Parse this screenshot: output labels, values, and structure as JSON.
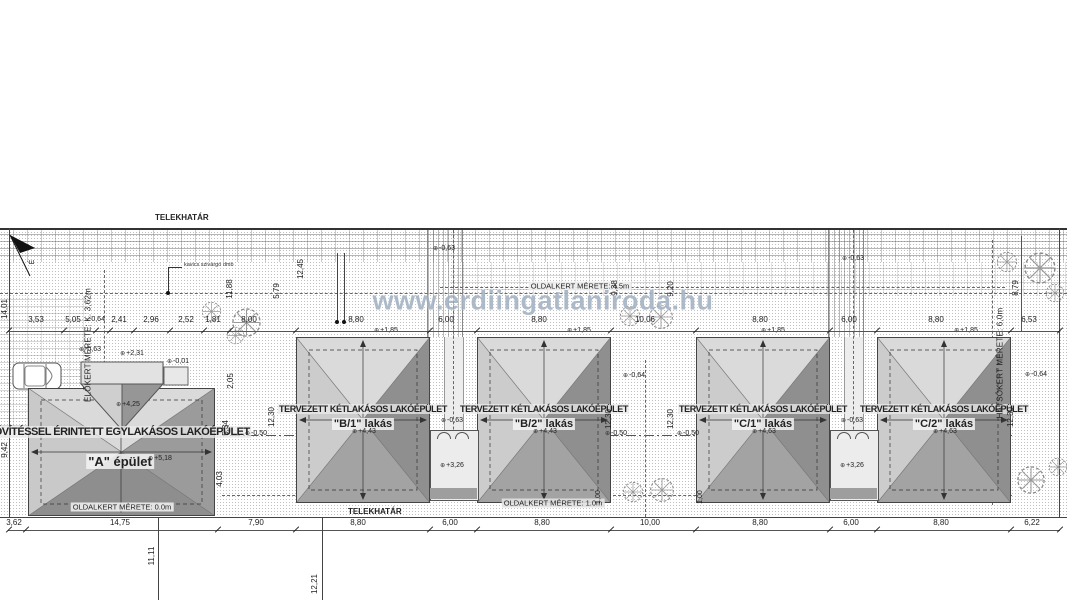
{
  "watermark": "www.erdiingatlaniroda.hu",
  "labels": {
    "telekhatar_top": "TELEKHATÁR",
    "telekhatar_bottom": "TELEKHATÁR",
    "elokert": "ELŐKERT MÉRETE: K. 3,62m",
    "hatsokert": "HÁTSÓKERT MÉRETE: 6,0m",
    "oldalkert_top": "OLDALKERT MÉRETE: 4.5m",
    "oldalkert_a": "OLDALKERT MÉRETE: 0.0m",
    "oldalkert_b": "OLDALKERT MÉRETE: 1.0m",
    "drain_note": "kavics szivárgó dmb",
    "north": "É"
  },
  "buildings": {
    "a": {
      "title": "BŐVÍTÉSSEL ÉRINTETT EGYLAKÁSOS LAKÓÉPÜLET",
      "name": "\"A\" épület",
      "ridge": "+5,18",
      "ext_corner": "-0,63",
      "ext_eave": "+2,31",
      "ext_ground": "-0,01",
      "ext_ridge": "+4,25"
    },
    "b1": {
      "title": "TERVEZETT KÉTLAKÁSOS LAKÓÉPÜLET",
      "name": "\"B/1\" lakás",
      "ridge": "+4,43",
      "eave": "+1,85"
    },
    "b2": {
      "title": "TERVEZETT KÉTLAKÁSOS LAKÓÉPÜLET",
      "name": "\"B/2\" lakás",
      "ridge": "+4,43",
      "eave": "+1,85"
    },
    "c1": {
      "title": "TERVEZETT KÉTLAKÁSOS LAKÓÉPÜLET",
      "name": "\"C/1\" lakás",
      "ridge": "+4,63",
      "eave": "+1,85"
    },
    "c2": {
      "title": "TERVEZETT KÉTLAKÁSOS LAKÓÉPÜLET",
      "name": "\"C/2\" lakás",
      "ridge": "+4,63",
      "eave": "+1,85"
    }
  },
  "connectors": {
    "b": {
      "ground": "-0,63",
      "terrace": "+3,26"
    },
    "c": {
      "ground": "-0,63",
      "terrace": "+3,26"
    }
  },
  "elev": {
    "gap_b": "-0,63",
    "gap_c": "-0,63",
    "mid": "-0,64",
    "right": "-0,64",
    "half1": "-0,50",
    "half2": "-0,50",
    "half3": "-0,50"
  },
  "dims_top": [
    "3,53",
    "5,05",
    "-0,64",
    "2,41",
    "2,96",
    "2,52",
    "1,81",
    "8,00",
    "8,80",
    "6,00",
    "8,80",
    "10,06",
    "8,80",
    "6,00",
    "8,80",
    "6,53"
  ],
  "dims_bottom": [
    "3,62",
    "14,75",
    "7,90",
    "8,80",
    "6,00",
    "8,80",
    "10,00",
    "8,80",
    "6,00",
    "8,80",
    "6,22"
  ],
  "dims_vert": {
    "left1": "14,01",
    "left2": "9,42",
    "ab1": "11,88",
    "ab2": "5,79",
    "ab3": "12,45",
    "ab4": "2,05",
    "ab5": "5,34",
    "ab6": "4,03",
    "ab7": "12,30",
    "mid1": "9,38",
    "mid2": "9,20",
    "mid3": "12,30",
    "mid4": "12,30",
    "gap1": "1,00",
    "gap2": "1,00",
    "right1": "8,79",
    "right2": "12,30",
    "below1": "11,11",
    "below2": "12,21"
  }
}
